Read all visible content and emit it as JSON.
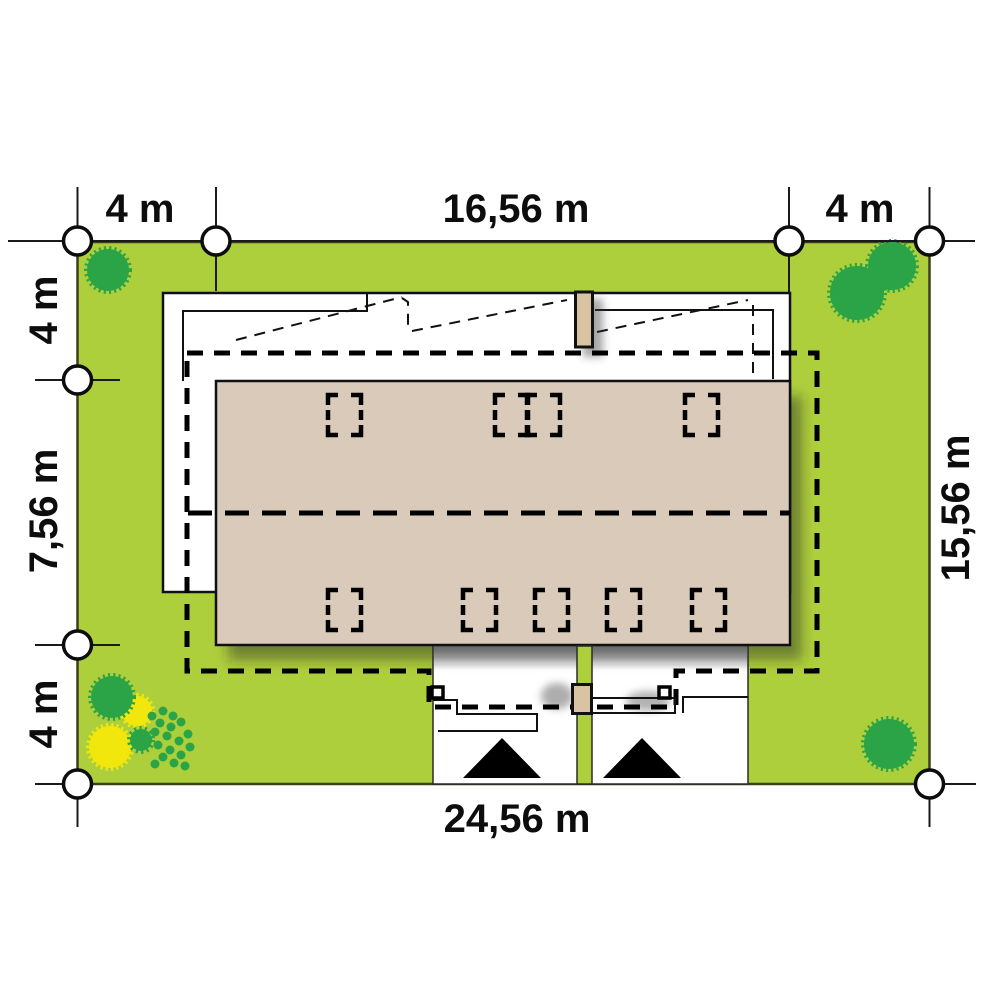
{
  "plan": {
    "dims": {
      "top_setback_left": "4 m",
      "top_width": "16,56 m",
      "top_setback_right": "4 m",
      "left_setback_top": "4 m",
      "left_depth": "7,56 m",
      "left_setback_bottom": "4 m",
      "right_depth": "15,56 m",
      "bottom_width": "24,56 m"
    },
    "colors": {
      "plot_green": "#aecf3c",
      "tree_green": "#2ba447",
      "shrub_yellow": "#f2e70d",
      "roof_beige": "#d9cab9",
      "chimney_tan": "#d8c3a3",
      "line": "#111111"
    }
  }
}
